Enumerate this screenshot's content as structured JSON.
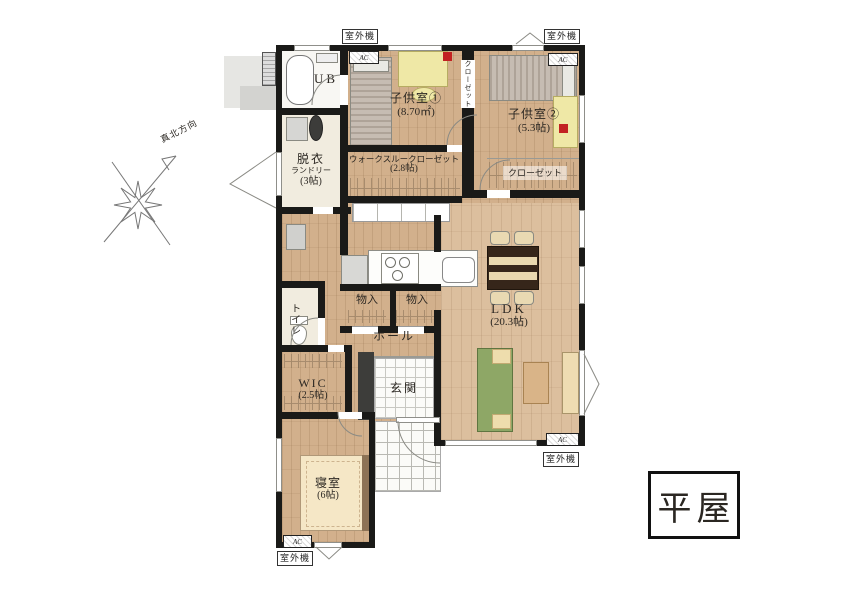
{
  "title": {
    "label": "平屋"
  },
  "compass": {
    "label": "真北方向"
  },
  "badges": {
    "outdoor_unit": "室外機",
    "ac": "AC"
  },
  "rooms": {
    "ub": {
      "name": "UB"
    },
    "kids1": {
      "name": "子供室①",
      "size": "(8.70㎡)"
    },
    "kids1_closet": {
      "name": "クローゼット"
    },
    "kids2": {
      "name": "子供室②",
      "size": "(5.3帖)"
    },
    "kids2_closet": {
      "name": "クローゼット"
    },
    "laundry": {
      "name": "脱衣",
      "name2": "ランドリー",
      "size": "(3帖)"
    },
    "walkthrough_closet": {
      "name": "ウォークスルークローゼット",
      "size": "(2.8帖)"
    },
    "toilet": {
      "name": "トイレ"
    },
    "storage_a": {
      "name": "物入"
    },
    "storage_b": {
      "name": "物入"
    },
    "hall": {
      "name": "ホール"
    },
    "ldk": {
      "name": "LDK",
      "size": "(20.3帖)"
    },
    "wic": {
      "name": "WIC",
      "size": "(2.5帖)"
    },
    "entrance": {
      "name": "玄関"
    },
    "bedroom": {
      "name": "寝室",
      "size": "(6帖)"
    }
  }
}
